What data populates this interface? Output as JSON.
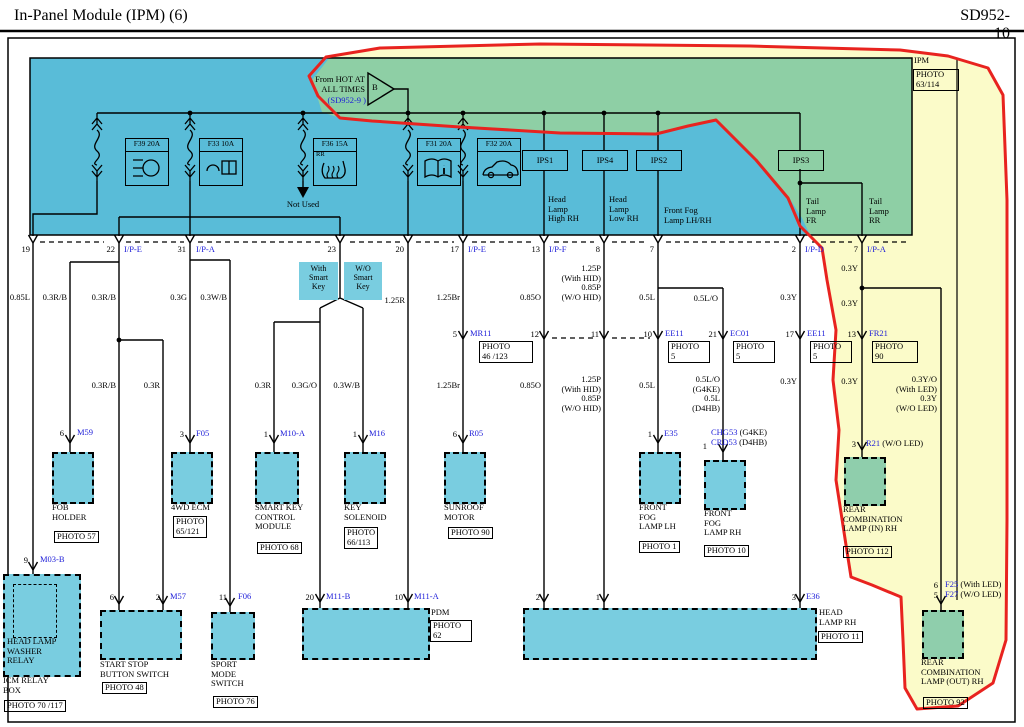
{
  "header": {
    "title": "In-Panel Module (IPM) (6)",
    "code": "SD952-10"
  },
  "power": {
    "l1": "From HOT AT\nALL TIMES",
    "ref": "(SD952-9 )",
    "tri": "B"
  },
  "ipm": {
    "name": "IPM",
    "photo": "PHOTO\n63/114"
  },
  "fuses": [
    {
      "label": "F39 20A",
      "icon": "headlamp-icon"
    },
    {
      "label": "F33 10A",
      "icon": "phone-book-icon"
    },
    {
      "label": "F36 15A",
      "sub": "RR",
      "icon": "seat-heater-icon"
    },
    {
      "label": "F31 20A",
      "icon": "info-book-icon"
    },
    {
      "label": "F32 20A",
      "icon": "car-icon"
    }
  ],
  "not_used": "Not Used",
  "ips": [
    "IPS1",
    "IPS4",
    "IPS2",
    "IPS3"
  ],
  "circuits": {
    "hl_high": "Head\nLamp\nHigh RH",
    "hl_low": "Head\nLamp\nLow RH",
    "fog": "Front Fog\nLamp LH/RH",
    "tail_fr": "Tail\nLamp\nFR",
    "tail_rr": "Tail\nLamp\nRR"
  },
  "pins_top": [
    {
      "no": "19",
      "conn": ""
    },
    {
      "no": "22",
      "conn": "I/P-E"
    },
    {
      "no": "31",
      "conn": "I/P-A"
    },
    {
      "no": "23",
      "conn": ""
    },
    {
      "no": "20",
      "conn": ""
    },
    {
      "no": "17",
      "conn": "I/P-E"
    },
    {
      "no": "13",
      "conn": "I/P-F"
    },
    {
      "no": "8",
      "conn": ""
    },
    {
      "no": "7",
      "conn": ""
    },
    {
      "no": "2",
      "conn": "I/P-D"
    },
    {
      "no": "7",
      "conn": "I/P-A"
    }
  ],
  "smart_key": {
    "with": "With\nSmart\nKey",
    "without": "W/O\nSmart\nKey"
  },
  "wires": {
    "w1": "0.85L",
    "w2": "0.3R/B",
    "w3": "0.3R/B",
    "w4": "0.3G",
    "w5": "0.3W/B",
    "w6": "1.25R",
    "w7": "1.25Br",
    "w8": "0.85O",
    "w9": "1.25P\n(With HID)\n0.85P\n(W/O HID)",
    "w10": "0.5L",
    "w11": "0.5L/O",
    "w12": "0.3Y",
    "w13": "0.3Y",
    "w14": "0.3Y",
    "r1": "0.3R/B",
    "r2": "0.3R",
    "r3": "0.3R",
    "r4": "0.3G/O",
    "r5": "0.3W/B",
    "r6": "1.25Br",
    "r7": "0.85O",
    "r8": "1.25P\n(With HID)\n0.85P\n(W/O HID)",
    "r9": "0.5L",
    "r10": "0.5L/O\n(G4KE)\n0.5L\n(D4HB)",
    "r11": "0.3Y",
    "r12": "0.3Y",
    "r13": "0.3Y/O\n(With LED)\n0.3Y\n(W/O LED)"
  },
  "mid": {
    "mr11": {
      "pin": "5",
      "name": "MR11",
      "photo": "PHOTO\n46 /123"
    },
    "p12": {
      "pin": "12"
    },
    "p11": {
      "pin": "11"
    },
    "ee11a": {
      "pin": "10",
      "name": "EE11",
      "photo": "PHOTO\n5"
    },
    "ec01": {
      "pin": "21",
      "name": "EC01",
      "photo": "PHOTO\n5"
    },
    "ee11b": {
      "pin": "17",
      "name": "EE11",
      "photo": "PHOTO\n5"
    },
    "fr21": {
      "pin": "13",
      "name": "FR21",
      "photo": "PHOTO\n90"
    }
  },
  "comp": {
    "fob": {
      "pin": "6",
      "conn": "M59",
      "label": "FOB\nHOLDER",
      "photo": "PHOTO 57"
    },
    "ecm": {
      "pin": "3",
      "conn": "F05",
      "label": "4WD ECM",
      "photo": "PHOTO\n65/121"
    },
    "skcm": {
      "pin": "1",
      "conn": "M10-A",
      "label": "SMART KEY\nCONTROL\nMODULE",
      "photo": "PHOTO 68"
    },
    "keysol": {
      "pin": "1",
      "conn": "M16",
      "label": "KEY\nSOLENOID",
      "photo": "PHOTO\n66/113"
    },
    "sunroof": {
      "pin": "6",
      "conn": "R05",
      "label": "SUNROOF\nMOTOR",
      "photo": "PHOTO 90"
    },
    "foglh": {
      "pin": "1",
      "conn": "E35",
      "label": "FRONT\nFOG\nLAMP LH",
      "photo": "PHOTO 1"
    },
    "fogrh": {
      "pin": "1",
      "conn": "CHG53",
      "note": "(G4KE)",
      "conn2": "CRD53",
      "note2": "(D4HB)",
      "label": "FRONT\nFOG\nLAMP RH",
      "photo": "PHOTO 10"
    },
    "rearin": {
      "pin": "3",
      "conn": "R21",
      "note": "(W/O LED)",
      "label": "REAR\nCOMBINATION\nLAMP (IN) RH",
      "photo": "PHOTO 112"
    },
    "icm": {
      "pin": "9",
      "conn": "M03-B",
      "label": "HEAD LAMP\nWASHER\nRELAY",
      "label2": "ICM RELAY\nBOX",
      "photo": "PHOTO 70 /117"
    },
    "startstop": {
      "pin": "6",
      "pin2": "2",
      "conn": "M57",
      "label": "START STOP\nBUTTON SWITCH",
      "photo": "PHOTO 48"
    },
    "sport": {
      "pin": "11",
      "conn": "F06",
      "label": "SPORT\nMODE\nSWITCH",
      "photo": "PHOTO 76"
    },
    "pdm": {
      "pin": "20",
      "conn": "M11-B",
      "pin2": "10",
      "conn2": "M11-A",
      "label": "PDM",
      "photo": "PHOTO\n62"
    },
    "hlrh": {
      "pin": "2",
      "pin2": "1",
      "pin3": "3",
      "conn3": "E36",
      "label": "HEAD\nLAMP RH",
      "photo": "PHOTO 11"
    },
    "rearout": {
      "pin": "6",
      "conn": "F25",
      "note": "(With LED)",
      "pin2": "5",
      "conn2": "F27",
      "note2": "(W/O LED)",
      "label": "REAR\nCOMBINATION\nLAMP (OUT) RH",
      "photo": "PHOTO 92"
    }
  },
  "colors": {
    "ipm_blue": "#59bcd8",
    "highlight_green": "#8ecfa5",
    "highlight_yellow": "#fbfbc9",
    "marker_red": "#e8231f",
    "component_cyan": "#79cde0",
    "lamp_green": "#8fceac",
    "connector_blue": "#1c1cd8"
  }
}
